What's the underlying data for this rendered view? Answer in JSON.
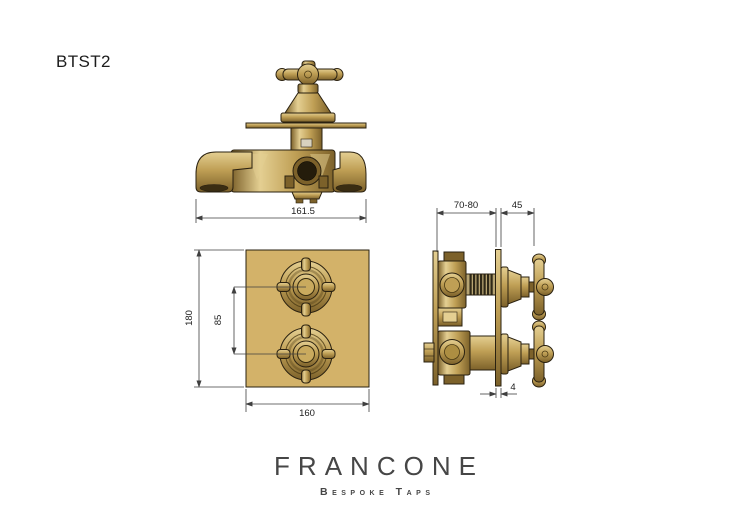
{
  "product": {
    "code": "BTST2"
  },
  "brand": {
    "name": "FRANCONE",
    "tagline": "Bespoke Taps"
  },
  "views": {
    "top": {
      "dim_width": "161.5"
    },
    "front": {
      "dim_height": "180",
      "dim_centers": "85",
      "dim_width": "160"
    },
    "side": {
      "dim_depth": "70-80",
      "dim_handle_projection": "45",
      "dim_plate_thickness": "4"
    }
  },
  "colors": {
    "background": "#ffffff",
    "brass": "#bf9f55",
    "brass_light": "#e4cf92",
    "brass_dark": "#7c612a",
    "plate": "#d3b269",
    "outline": "#2a2110",
    "dim_line": "#3f3f3f",
    "text": "#1c1c1c",
    "logo": "#464646"
  }
}
